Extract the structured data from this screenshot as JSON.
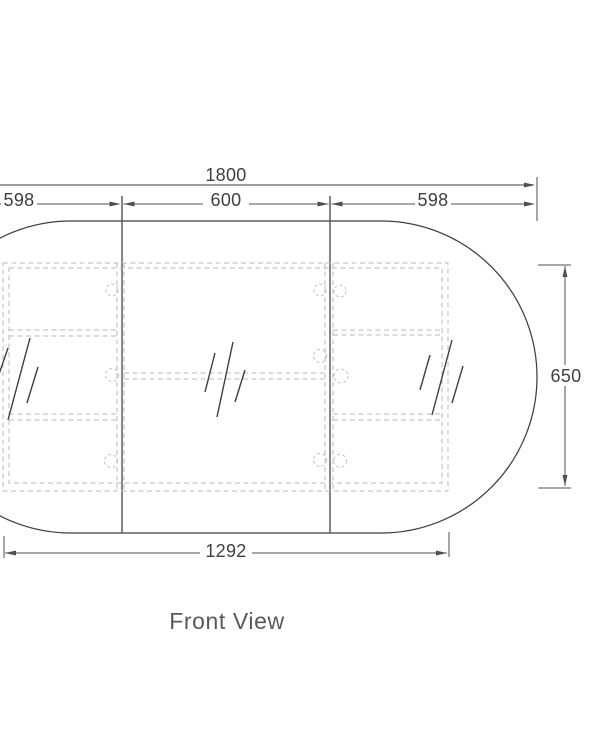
{
  "view_label": "Front View",
  "dimensions": {
    "overall_width": "1800",
    "segments": [
      "598",
      "600",
      "598"
    ],
    "side_height": "650",
    "bottom_width": "1292"
  },
  "colors": {
    "background": "#ffffff",
    "outline": "#3f3f3f",
    "dimension_line": "#4f4f4f",
    "hidden_line": "#b9b9b9",
    "pin_circle": "#c3c3c3",
    "view_label_text": "#58595b"
  }
}
